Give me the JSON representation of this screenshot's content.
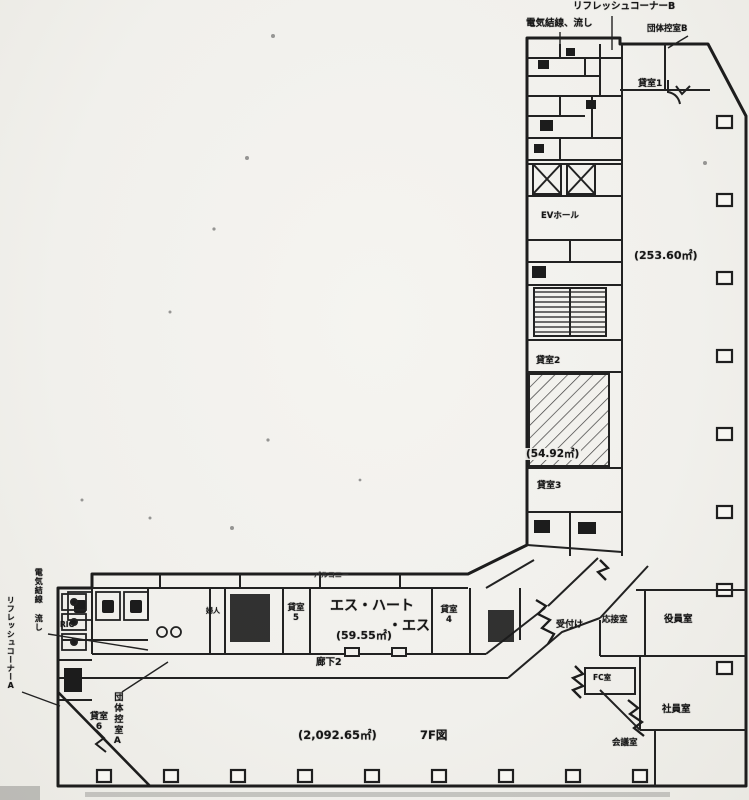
{
  "plan": {
    "floor_summary": {
      "total_area": "(2,092.65㎡)",
      "floor_label": "7F図"
    },
    "annotations": {
      "refresh_corner_b": "リフレッシュコーナーB",
      "electric_note_top": "電気結線、流し",
      "group_room_b": "団体控室B",
      "electric_note_left": "電気結線 流し",
      "refresh_corner_a": "リフレッシュコーナーA",
      "group_room_a": "団体控室A",
      "balcony": "バルコニー"
    },
    "rooms": {
      "rental1": {
        "label": "貸室1",
        "area": "(253.60㎡)"
      },
      "rental2": {
        "label": "貸室2"
      },
      "hatched_area": "(54.92㎡)",
      "rental3": {
        "label": "貸室3"
      },
      "rental4": {
        "label": "貸室",
        "num": "4"
      },
      "rental5": {
        "label": "貸室",
        "num": "5"
      },
      "rental6": {
        "label": "貸室",
        "num": "6"
      },
      "ev_hall": "EVホール",
      "tenant_name_line1": "エス・ハート",
      "tenant_name_line2": "・エス",
      "tenant_area": "(59.55㎡)",
      "corridor2": "廊下2",
      "reception": "受付け",
      "drawing_room": "応接室",
      "executive_room": "役員室",
      "fc_room": "FC室",
      "staff_room": "社員室",
      "meeting_room": "会議室",
      "ric": "RIC",
      "womens": "婦人"
    }
  }
}
